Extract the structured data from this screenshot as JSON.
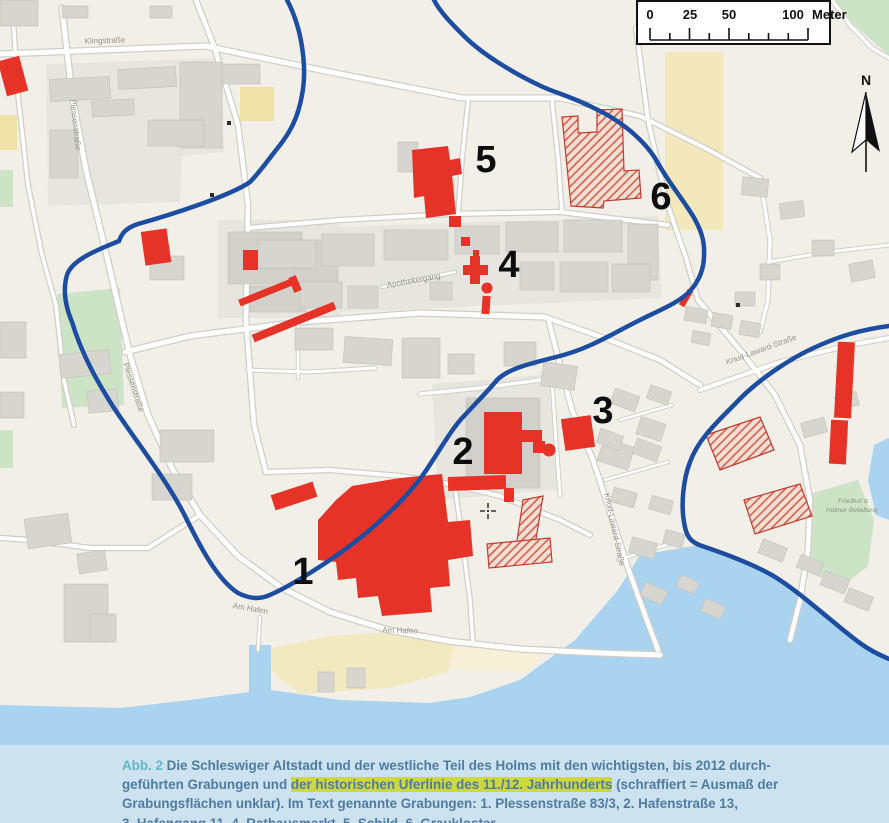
{
  "map": {
    "scale_bar": {
      "tick_labels": [
        "0",
        "25",
        "50",
        "100"
      ],
      "unit": "Meter"
    },
    "north_label": "N",
    "site_numbers": [
      "1",
      "2",
      "3",
      "4",
      "5",
      "6"
    ],
    "street_labels": {
      "klingstrasse": "Klingstraße",
      "plessenstrasse": "Plessenstraße",
      "am_hafen": "Am Hafen",
      "knud_laward": "Knud-Laward-Straße",
      "apothekergang": "Apothekergang"
    },
    "poi": {
      "friedhof_line1": "Friedhof d.",
      "friedhof_line2": "Holmer Beliebung"
    },
    "colors": {
      "excavation_red": "#e63327",
      "shoreline_blue": "#1c4da0",
      "water": "#a9d3ee",
      "green": "#cde3c6",
      "building_gray": "#d7d5cf",
      "highlight": "#ccd83e"
    }
  },
  "caption": {
    "figure_label": "Abb. 2",
    "line1": " Die Schleswiger Altstadt und der westliche Teil des Holms mit den wichtigsten, bis 2012 durch-",
    "line2_pre": "geführten Grabungen und ",
    "line2_highlight": "der historischen Uferlinie des 11./12. Jahrhunderts",
    "line2_post": " (schraffiert = Ausmaß der",
    "line3": "Grabungsflächen unklar). Im Text genannte Grabungen: 1. Plessenstraße 83/3, 2. Hafenstraße 13,",
    "line4": "3. Hafengang 11, 4. Rathausmarkt, 5. Schild, 6. Graukloster"
  }
}
